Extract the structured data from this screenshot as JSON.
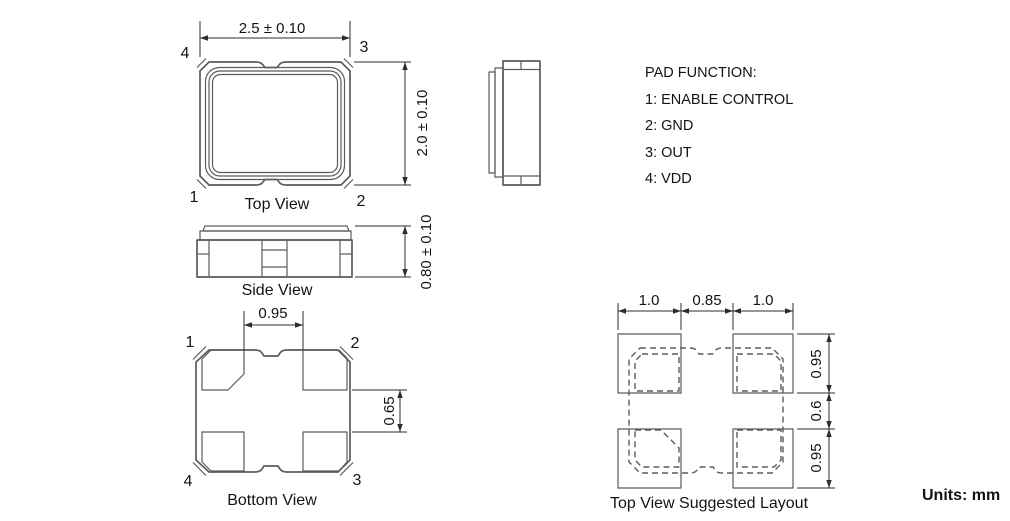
{
  "views": {
    "top": {
      "label": "Top View",
      "width_dim": "2.5 ± 0.10",
      "height_dim": "2.0 ± 0.10",
      "pin_top_left": "4",
      "pin_top_right": "3",
      "pin_bottom_left": "1",
      "pin_bottom_right": "2"
    },
    "side": {
      "label": "Side View",
      "height_dim": "0.80 ± 0.10"
    },
    "bottom": {
      "label": "Bottom View",
      "pad_gap_x": "0.95",
      "pad_gap_y": "0.65",
      "pin_top_left": "1",
      "pin_top_right": "2",
      "pin_bottom_left": "4",
      "pin_bottom_right": "3"
    },
    "layout": {
      "label": "Top View Suggested Layout",
      "dim_left_pad_width": "1.0",
      "dim_center_gap": "0.85",
      "dim_right_pad_width": "1.0",
      "dim_top_pad_height": "0.95",
      "dim_middle_gap": "0.6",
      "dim_bottom_pad_height": "0.95"
    }
  },
  "pad_function": {
    "title": "PAD FUNCTION:",
    "items": [
      "1: ENABLE CONTROL",
      "2: GND",
      "3: OUT",
      "4: VDD"
    ]
  },
  "units_label": "Units: mm",
  "colors": {
    "line": "#5a5b60",
    "dimension": "#2b2c30",
    "text": "#141414",
    "background": "#ffffff"
  }
}
